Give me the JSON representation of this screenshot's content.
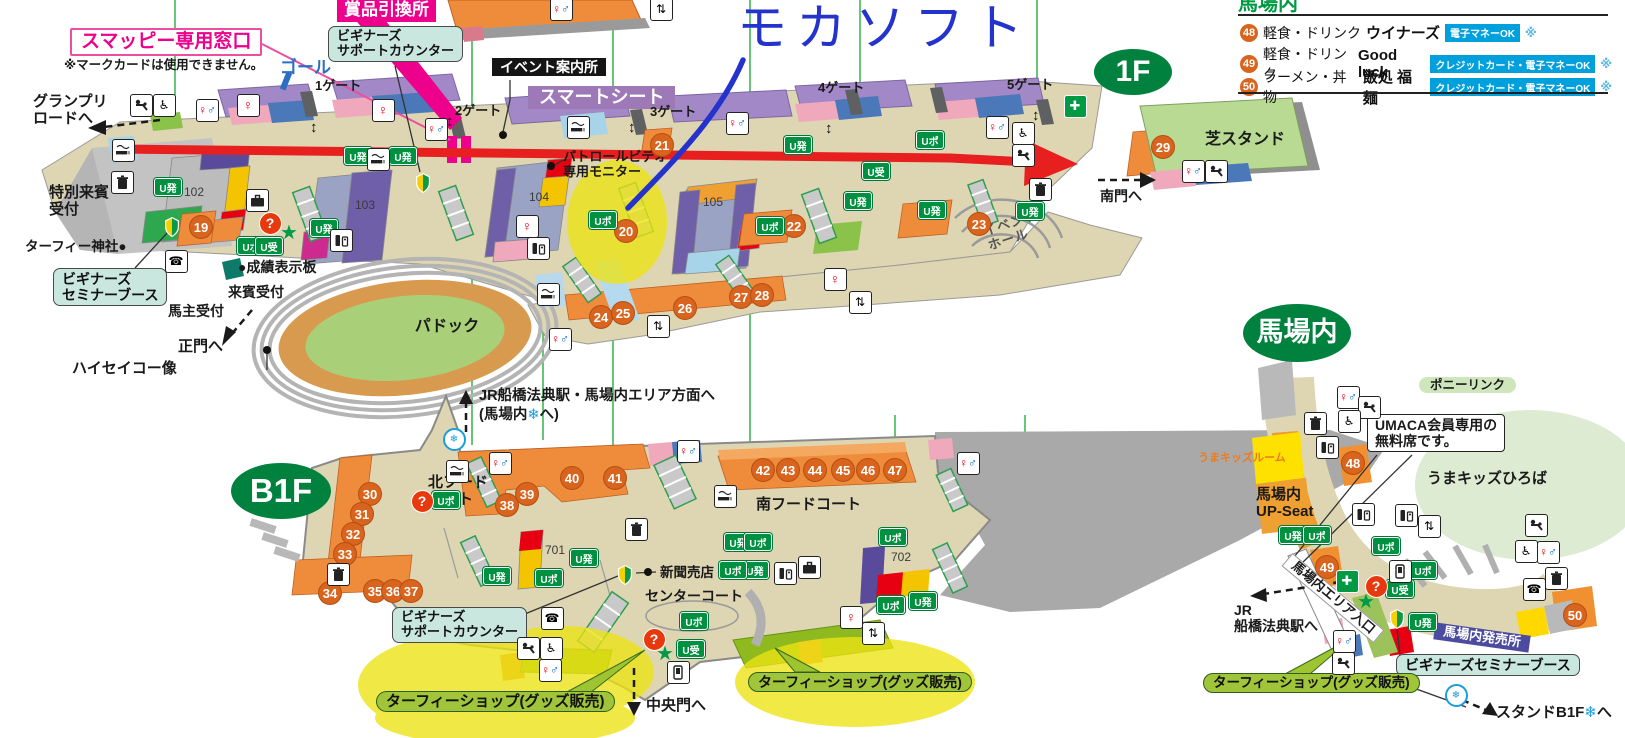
{
  "annotations": {
    "handwriting_text": "モカソフト",
    "pen_color": "#2433cc",
    "arrow_color": "#e81f1f",
    "highlight_color": "#ece312"
  },
  "legend": {
    "heading": "馬場内",
    "items": [
      {
        "num": "48",
        "category": "軽食・ドリンク",
        "name": "ウイナーズ",
        "badge": "電子マネーOK",
        "note": "※"
      },
      {
        "num": "49",
        "category": "軽食・ドリンク",
        "name": "Good luck",
        "badge": "クレジットカード・電子マネーOK",
        "note": "※"
      },
      {
        "num": "50",
        "category": "ラーメン・丼物",
        "name": "飯処 福麺",
        "badge": "クレジットカード・電子マネーOK",
        "note": "※"
      }
    ]
  },
  "labels": [
    {
      "t": "賞品引換所",
      "x": 337,
      "y": 0,
      "c": "pink-banner",
      "s": 17,
      "nm": "prize-exchange-callout"
    },
    {
      "t": "スマッピー専用窓口",
      "x": 70,
      "y": 28,
      "c": "pink-outline",
      "s": 19,
      "nm": "smappy-window-callout"
    },
    {
      "t": "※マークカードは使用できません。",
      "x": 64,
      "y": 58,
      "c": "plain",
      "s": 12.5,
      "nm": "mark-card-note"
    },
    {
      "t": "ビギナーズ\nサポートカウンター",
      "x": 328,
      "y": 26,
      "c": "teal-call",
      "s": 13,
      "nm": "beginners-support-counter-callout-1f"
    },
    {
      "t": "ゴール",
      "x": 280,
      "y": 58,
      "c": "goal",
      "s": 17,
      "nm": "goal-label"
    },
    {
      "t": "1ゲート",
      "x": 315,
      "y": 79,
      "c": "plain",
      "s": 13,
      "nm": "gate-1-label"
    },
    {
      "t": "イベント案内所",
      "x": 492,
      "y": 58,
      "c": "black-banner",
      "s": 14,
      "nm": "event-info-callout"
    },
    {
      "t": "スマートシート",
      "x": 528,
      "y": 86,
      "c": "purple-banner",
      "s": 18,
      "nm": "smart-seat-banner"
    },
    {
      "t": "2ゲート",
      "x": 455,
      "y": 104,
      "c": "plain",
      "s": 13,
      "nm": "gate-2-label"
    },
    {
      "t": "3ゲート",
      "x": 650,
      "y": 105,
      "c": "plain",
      "s": 13,
      "nm": "gate-3-label"
    },
    {
      "t": "4ゲート",
      "x": 818,
      "y": 81,
      "c": "plain",
      "s": 13,
      "nm": "gate-4-label"
    },
    {
      "t": "5ゲート",
      "x": 1007,
      "y": 78,
      "c": "plain",
      "s": 13,
      "nm": "gate-5-label"
    },
    {
      "t": "モカソフト",
      "x": 737,
      "y": 0,
      "c": "handwriting",
      "s": 50,
      "nm": "handwritten-mocha-soft"
    },
    {
      "t": "1F",
      "x": 1133,
      "y": 72,
      "c": "oval",
      "s": 30,
      "w": 78,
      "h": 46,
      "ctr": true,
      "nm": "floor-1f-badge"
    },
    {
      "t": "グランプリ\nロードへ",
      "x": 33,
      "y": 93,
      "c": "plain",
      "s": 15,
      "nm": "grand-prix-road-direction"
    },
    {
      "t": "特別来賓\n受付",
      "x": 79,
      "y": 201,
      "c": "plain",
      "s": 15,
      "ctr": true,
      "nm": "special-guest-reception-label"
    },
    {
      "t": "ターフィー神社●",
      "x": 25,
      "y": 239,
      "c": "plain",
      "s": 13.5,
      "nm": "turfy-shrine-label"
    },
    {
      "t": "ビギナーズ\nセミナーブース",
      "x": 53,
      "y": 268,
      "c": "teal-call",
      "s": 14,
      "nm": "beginners-seminar-booth-callout-1f"
    },
    {
      "t": "馬主受付",
      "x": 168,
      "y": 303,
      "c": "plain",
      "s": 14,
      "nm": "owner-reception-label"
    },
    {
      "t": "来賓受付",
      "x": 228,
      "y": 284,
      "c": "plain",
      "s": 14,
      "nm": "guest-reception-label"
    },
    {
      "t": "●成績表示板",
      "x": 238,
      "y": 259,
      "c": "plain",
      "s": 14,
      "nm": "results-board-label"
    },
    {
      "t": "正門へ",
      "x": 178,
      "y": 338,
      "c": "plain",
      "s": 15,
      "nm": "main-gate-direction"
    },
    {
      "t": "ハイセイコー像",
      "x": 72,
      "y": 360,
      "c": "plain",
      "s": 15,
      "nm": "haiseiko-statue-label"
    },
    {
      "t": "パドック",
      "x": 447,
      "y": 327,
      "c": "plain",
      "s": 16,
      "ctr": true,
      "nm": "paddock-label"
    },
    {
      "t": "102",
      "x": 184,
      "y": 186,
      "c": "numtext",
      "s": 12,
      "nm": "block-102-label"
    },
    {
      "t": "103",
      "x": 355,
      "y": 199,
      "c": "numtext",
      "s": 12,
      "nm": "block-103-label"
    },
    {
      "t": "104",
      "x": 529,
      "y": 191,
      "c": "numtext",
      "s": 12,
      "nm": "block-104-label"
    },
    {
      "t": "105",
      "x": 703,
      "y": 196,
      "c": "numtext",
      "s": 12,
      "nm": "block-105-label"
    },
    {
      "t": "パトロールビデオ\n専用モニター",
      "x": 563,
      "y": 150,
      "c": "plain",
      "s": 13,
      "nm": "patrol-video-label"
    },
    {
      "t": "イベント\nホール",
      "x": 985,
      "y": 216,
      "c": "evt",
      "s": 13,
      "r": -18,
      "nm": "event-hall-label"
    },
    {
      "t": "南門へ",
      "x": 1100,
      "y": 188,
      "c": "plain",
      "s": 14,
      "nm": "south-gate-direction"
    },
    {
      "t": "芝スタンド",
      "x": 1245,
      "y": 140,
      "c": "plain",
      "s": 16,
      "ctr": true,
      "nm": "turf-stand-label"
    },
    {
      "t": "B1F",
      "x": 281,
      "y": 491,
      "c": "oval",
      "s": 33,
      "w": 100,
      "h": 56,
      "ctr": true,
      "nm": "floor-b1f-badge"
    },
    {
      "t": "JR船橋法典駅・馬場内エリア方面へ",
      "x": 479,
      "y": 388,
      "c": "plain",
      "s": 14.5,
      "nm": "jr-funabashi-hoten-direction"
    },
    {
      "t": "(馬場内❄へ)",
      "x": 479,
      "y": 407,
      "c": "plain",
      "s": 14.5,
      "nm": "babanai-snow-direction"
    },
    {
      "t": "北フード\nコート",
      "x": 428,
      "y": 474,
      "c": "plain",
      "s": 15,
      "nm": "north-food-court-label"
    },
    {
      "t": "南フードコート",
      "x": 756,
      "y": 496,
      "c": "plain",
      "s": 15,
      "nm": "south-food-court-label"
    },
    {
      "t": "センターコート",
      "x": 645,
      "y": 588,
      "c": "plain",
      "s": 14,
      "nm": "center-court-label"
    },
    {
      "t": "新聞売店",
      "x": 660,
      "y": 565,
      "c": "plain",
      "s": 13.5,
      "nm": "newspaper-stand-label"
    },
    {
      "t": "701",
      "x": 545,
      "y": 544,
      "c": "numtext",
      "s": 12,
      "nm": "block-701-label"
    },
    {
      "t": "702",
      "x": 891,
      "y": 551,
      "c": "numtext",
      "s": 12,
      "nm": "block-702-label"
    },
    {
      "t": "ビギナーズ\nサポートカウンター",
      "x": 392,
      "y": 607,
      "c": "teal-call",
      "s": 13,
      "nm": "beginners-support-counter-callout-b1f"
    },
    {
      "t": "ターフィーショップ(グッズ販売)",
      "x": 376,
      "y": 691,
      "c": "green-call",
      "s": 15,
      "nm": "turfy-shop-callout-left"
    },
    {
      "t": "ターフィーショップ(グッズ販売)",
      "x": 748,
      "y": 672,
      "c": "green-call",
      "s": 14,
      "nm": "turfy-shop-callout-right"
    },
    {
      "t": "中央門へ",
      "x": 646,
      "y": 697,
      "c": "plain",
      "s": 15,
      "nm": "central-gate-direction"
    },
    {
      "t": "馬場内",
      "x": 1297,
      "y": 333,
      "c": "oval",
      "s": 27,
      "w": 108,
      "h": 58,
      "ctr": true,
      "nm": "babanai-area-badge"
    },
    {
      "t": "ポニーリンク",
      "x": 1419,
      "y": 377,
      "c": "pill-green",
      "s": 12.5,
      "nm": "pony-link-label"
    },
    {
      "t": "UMACA会員専用の\n無料席です。",
      "x": 1367,
      "y": 414,
      "c": "white-call",
      "s": 14,
      "nm": "umaca-note-callout"
    },
    {
      "t": "うまキッズひろば",
      "x": 1427,
      "y": 470,
      "c": "plain",
      "s": 15,
      "nm": "uma-kids-hiroba-label"
    },
    {
      "t": "うまキッズルーム",
      "x": 1198,
      "y": 452,
      "c": "kids",
      "s": 11,
      "nm": "uma-kids-room-label"
    },
    {
      "t": "馬場内\nUP-Seat",
      "x": 1256,
      "y": 486,
      "c": "plain",
      "s": 15,
      "nm": "babanai-up-seat-label"
    },
    {
      "t": "馬場内エリア入口",
      "x": 1333,
      "y": 598,
      "c": "rot-strip",
      "s": 13,
      "r": 40,
      "ctr": true,
      "nm": "babanai-entrance-label"
    },
    {
      "t": "JR\n船橋法典駅へ",
      "x": 1234,
      "y": 602,
      "c": "plain",
      "s": 14,
      "nm": "jr-funabashi-hoten-station-direction"
    },
    {
      "t": "馬場内発売所",
      "x": 1434,
      "y": 629,
      "c": "purple-strip",
      "s": 13,
      "r": 8,
      "nm": "babanai-ticket-office-label"
    },
    {
      "t": "ビギナーズセミナーブース",
      "x": 1396,
      "y": 654,
      "c": "teal-call",
      "s": 14,
      "nm": "beginners-seminar-booth-callout-babanai"
    },
    {
      "t": "ターフィーショップ(グッズ販売)",
      "x": 1203,
      "y": 673,
      "c": "green-call",
      "s": 13.5,
      "nm": "turfy-shop-callout-babanai"
    },
    {
      "t": "スタンドB1F❄へ",
      "x": 1496,
      "y": 704,
      "c": "plain",
      "s": 15,
      "nm": "stand-b1f-direction"
    }
  ],
  "circles": [
    {
      "n": "19",
      "x": 200,
      "y": 226
    },
    {
      "n": "20",
      "x": 625,
      "y": 230
    },
    {
      "n": "21",
      "x": 661,
      "y": 144
    },
    {
      "n": "22",
      "x": 793,
      "y": 225
    },
    {
      "n": "23",
      "x": 978,
      "y": 223
    },
    {
      "n": "24",
      "x": 600,
      "y": 316
    },
    {
      "n": "25",
      "x": 622,
      "y": 312
    },
    {
      "n": "26",
      "x": 684,
      "y": 307
    },
    {
      "n": "27",
      "x": 740,
      "y": 296
    },
    {
      "n": "28",
      "x": 761,
      "y": 294
    },
    {
      "n": "29",
      "x": 1162,
      "y": 146
    },
    {
      "n": "30",
      "x": 369,
      "y": 493
    },
    {
      "n": "31",
      "x": 361,
      "y": 513
    },
    {
      "n": "32",
      "x": 352,
      "y": 533
    },
    {
      "n": "33",
      "x": 344,
      "y": 553
    },
    {
      "n": "34",
      "x": 329,
      "y": 592
    },
    {
      "n": "35",
      "x": 374,
      "y": 590
    },
    {
      "n": "36",
      "x": 392,
      "y": 590
    },
    {
      "n": "37",
      "x": 410,
      "y": 590
    },
    {
      "n": "38",
      "x": 506,
      "y": 504
    },
    {
      "n": "39",
      "x": 526,
      "y": 493
    },
    {
      "n": "40",
      "x": 571,
      "y": 477
    },
    {
      "n": "41",
      "x": 614,
      "y": 477
    },
    {
      "n": "42",
      "x": 762,
      "y": 469
    },
    {
      "n": "43",
      "x": 787,
      "y": 469
    },
    {
      "n": "44",
      "x": 814,
      "y": 469
    },
    {
      "n": "45",
      "x": 842,
      "y": 469
    },
    {
      "n": "46",
      "x": 867,
      "y": 469
    },
    {
      "n": "47",
      "x": 894,
      "y": 469
    },
    {
      "n": "48",
      "x": 1352,
      "y": 462
    },
    {
      "n": "49",
      "x": 1326,
      "y": 566
    },
    {
      "n": "50",
      "x": 1574,
      "y": 614
    }
  ],
  "u_badges": [
    {
      "t": "U発",
      "x": 167,
      "y": 186
    },
    {
      "t": "U発",
      "x": 357,
      "y": 155
    },
    {
      "t": "U発",
      "x": 402,
      "y": 155
    },
    {
      "t": "U発",
      "x": 323,
      "y": 227
    },
    {
      "t": "U発",
      "x": 797,
      "y": 144
    },
    {
      "t": "U発",
      "x": 857,
      "y": 200
    },
    {
      "t": "U発",
      "x": 931,
      "y": 209
    },
    {
      "t": "U発",
      "x": 1029,
      "y": 210
    },
    {
      "t": "U発",
      "x": 583,
      "y": 557
    },
    {
      "t": "U発",
      "x": 496,
      "y": 575
    },
    {
      "t": "U発",
      "x": 737,
      "y": 541
    },
    {
      "t": "U発",
      "x": 754,
      "y": 569
    },
    {
      "t": "U発",
      "x": 922,
      "y": 600
    },
    {
      "t": "U発",
      "x": 1292,
      "y": 534
    },
    {
      "t": "U発",
      "x": 1422,
      "y": 621
    },
    {
      "t": "Uポ",
      "x": 250,
      "y": 245
    },
    {
      "t": "Uポ",
      "x": 602,
      "y": 219
    },
    {
      "t": "Uポ",
      "x": 929,
      "y": 139
    },
    {
      "t": "Uポ",
      "x": 769,
      "y": 225
    },
    {
      "t": "Uポ",
      "x": 445,
      "y": 499
    },
    {
      "t": "Uポ",
      "x": 548,
      "y": 577
    },
    {
      "t": "Uポ",
      "x": 757,
      "y": 541
    },
    {
      "t": "Uポ",
      "x": 732,
      "y": 569
    },
    {
      "t": "Uポ",
      "x": 890,
      "y": 604
    },
    {
      "t": "Uポ",
      "x": 693,
      "y": 620
    },
    {
      "t": "Uポ",
      "x": 892,
      "y": 536
    },
    {
      "t": "Uポ",
      "x": 1316,
      "y": 534
    },
    {
      "t": "Uポ",
      "x": 1385,
      "y": 545
    },
    {
      "t": "Uポ",
      "x": 1422,
      "y": 569
    },
    {
      "t": "U受",
      "x": 268,
      "y": 245
    },
    {
      "t": "U受",
      "x": 875,
      "y": 170
    },
    {
      "t": "U受",
      "x": 690,
      "y": 648
    },
    {
      "t": "U受",
      "x": 1399,
      "y": 588
    }
  ],
  "icons": [
    {
      "k": "baby",
      "x": 140,
      "y": 104
    },
    {
      "k": "wheelchair",
      "x": 163,
      "y": 104
    },
    {
      "k": "restroom",
      "x": 206,
      "y": 109
    },
    {
      "k": "women",
      "x": 247,
      "y": 104
    },
    {
      "k": "women",
      "x": 382,
      "y": 109
    },
    {
      "k": "restroom",
      "x": 435,
      "y": 128
    },
    {
      "k": "smoking",
      "x": 122,
      "y": 149
    },
    {
      "k": "trash",
      "x": 121,
      "y": 181
    },
    {
      "k": "phone",
      "x": 175,
      "y": 260
    },
    {
      "k": "restroom",
      "x": 560,
      "y": 8
    },
    {
      "k": "elevator",
      "x": 660,
      "y": 8
    },
    {
      "k": "smoking",
      "x": 577,
      "y": 126
    },
    {
      "k": "restroom",
      "x": 736,
      "y": 122
    },
    {
      "k": "restroom",
      "x": 996,
      "y": 126
    },
    {
      "k": "wheelchair",
      "x": 1022,
      "y": 132
    },
    {
      "k": "baby",
      "x": 1022,
      "y": 154
    },
    {
      "k": "firstaid",
      "x": 1074,
      "y": 105
    },
    {
      "k": "trash",
      "x": 1039,
      "y": 188
    },
    {
      "k": "lockers",
      "x": 256,
      "y": 199
    },
    {
      "k": "smoking",
      "x": 377,
      "y": 158
    },
    {
      "k": "recycle",
      "x": 340,
      "y": 239
    },
    {
      "k": "women",
      "x": 526,
      "y": 225
    },
    {
      "k": "recycle",
      "x": 537,
      "y": 247
    },
    {
      "k": "smoking",
      "x": 547,
      "y": 293
    },
    {
      "k": "restroom",
      "x": 559,
      "y": 338
    },
    {
      "k": "elevator",
      "x": 657,
      "y": 325
    },
    {
      "k": "women",
      "x": 834,
      "y": 278
    },
    {
      "k": "elevator",
      "x": 859,
      "y": 301
    },
    {
      "k": "restroom",
      "x": 1192,
      "y": 170
    },
    {
      "k": "baby",
      "x": 1215,
      "y": 170
    },
    {
      "k": "question",
      "x": 269,
      "y": 222
    },
    {
      "k": "star",
      "x": 289,
      "y": 229
    },
    {
      "k": "beginner",
      "x": 172,
      "y": 225
    },
    {
      "k": "beginner",
      "x": 423,
      "y": 181
    },
    {
      "k": "updown",
      "x": 319,
      "y": 128
    },
    {
      "k": "updown",
      "x": 455,
      "y": 122
    },
    {
      "k": "updown",
      "x": 637,
      "y": 128
    },
    {
      "k": "updown",
      "x": 834,
      "y": 129
    },
    {
      "k": "updown",
      "x": 1041,
      "y": 116
    },
    {
      "k": "slash",
      "x": 293,
      "y": 82
    },
    {
      "k": "snowflake",
      "x": 453,
      "y": 438
    },
    {
      "k": "smoking",
      "x": 456,
      "y": 470
    },
    {
      "k": "restroom",
      "x": 499,
      "y": 462
    },
    {
      "k": "restroom",
      "x": 687,
      "y": 450
    },
    {
      "k": "restroom",
      "x": 967,
      "y": 462
    },
    {
      "k": "trash",
      "x": 635,
      "y": 528
    },
    {
      "k": "trash",
      "x": 337,
      "y": 573
    },
    {
      "k": "smoking",
      "x": 724,
      "y": 495
    },
    {
      "k": "recycle",
      "x": 784,
      "y": 572
    },
    {
      "k": "lockers",
      "x": 808,
      "y": 566
    },
    {
      "k": "women",
      "x": 850,
      "y": 616
    },
    {
      "k": "elevator",
      "x": 872,
      "y": 632
    },
    {
      "k": "phone",
      "x": 551,
      "y": 617
    },
    {
      "k": "baby",
      "x": 527,
      "y": 647
    },
    {
      "k": "wheelchair",
      "x": 550,
      "y": 647
    },
    {
      "k": "restroom",
      "x": 549,
      "y": 669
    },
    {
      "k": "mobile",
      "x": 677,
      "y": 671
    },
    {
      "k": "question",
      "x": 421,
      "y": 500
    },
    {
      "k": "question",
      "x": 653,
      "y": 638
    },
    {
      "k": "star",
      "x": 665,
      "y": 650
    },
    {
      "k": "beginner",
      "x": 625,
      "y": 573
    },
    {
      "k": "restroom",
      "x": 1347,
      "y": 396
    },
    {
      "k": "baby",
      "x": 1368,
      "y": 406
    },
    {
      "k": "wheelchair",
      "x": 1348,
      "y": 420
    },
    {
      "k": "trash",
      "x": 1314,
      "y": 422
    },
    {
      "k": "recycle",
      "x": 1326,
      "y": 446
    },
    {
      "k": "recycle",
      "x": 1362,
      "y": 513
    },
    {
      "k": "recycle",
      "x": 1405,
      "y": 514
    },
    {
      "k": "elevator",
      "x": 1428,
      "y": 525
    },
    {
      "k": "mobile",
      "x": 1399,
      "y": 570
    },
    {
      "k": "firstaid",
      "x": 1346,
      "y": 580
    },
    {
      "k": "question",
      "x": 1375,
      "y": 585
    },
    {
      "k": "star",
      "x": 1366,
      "y": 598
    },
    {
      "k": "beginner",
      "x": 1397,
      "y": 617
    },
    {
      "k": "baby",
      "x": 1535,
      "y": 524
    },
    {
      "k": "wheelchair",
      "x": 1525,
      "y": 550
    },
    {
      "k": "restroom",
      "x": 1547,
      "y": 551
    },
    {
      "k": "phone",
      "x": 1533,
      "y": 588
    },
    {
      "k": "trash",
      "x": 1555,
      "y": 577
    },
    {
      "k": "restroom",
      "x": 1343,
      "y": 640
    },
    {
      "k": "baby",
      "x": 1342,
      "y": 662
    },
    {
      "k": "snowflake",
      "x": 1455,
      "y": 694
    }
  ]
}
